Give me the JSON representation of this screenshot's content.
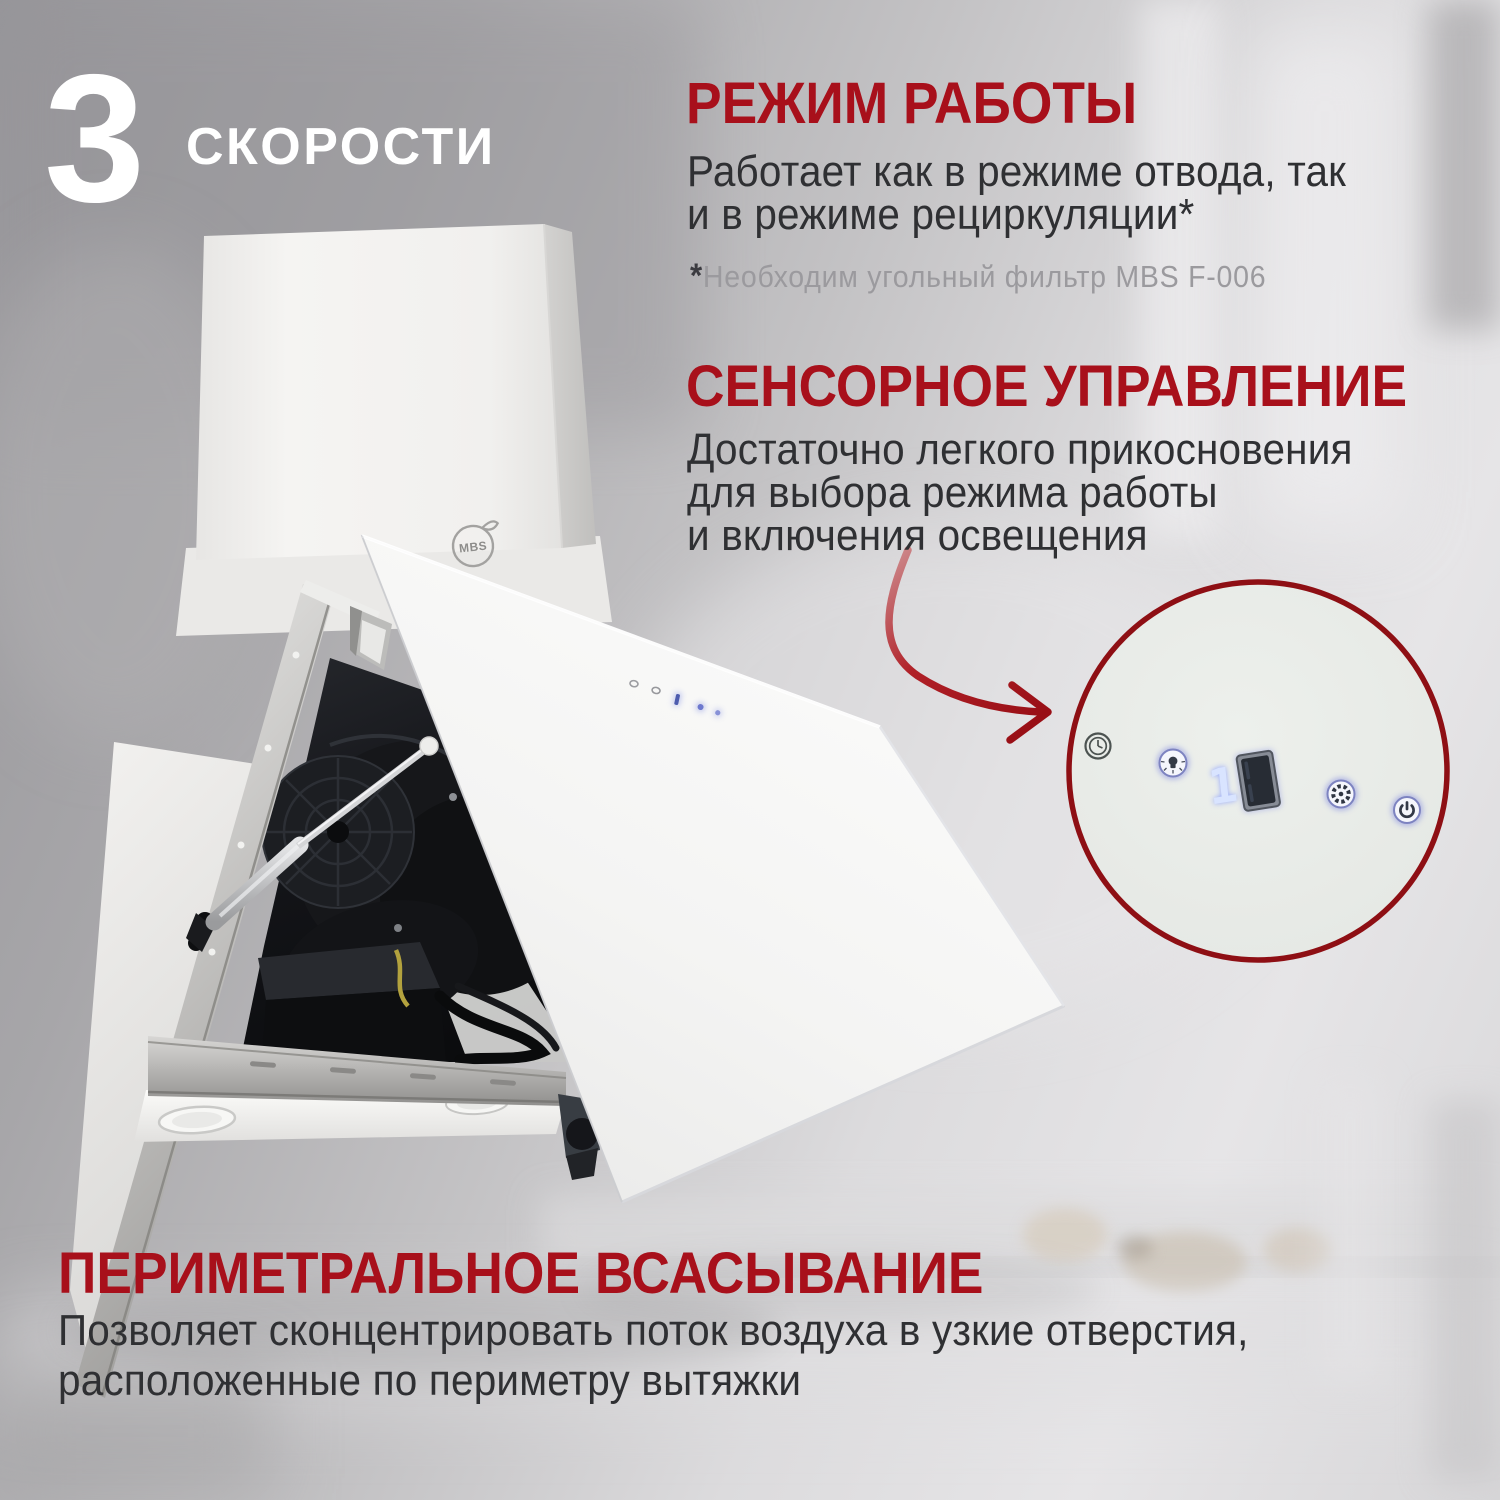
{
  "badge": {
    "number": "3",
    "label": "СКОРОСТИ"
  },
  "sections": {
    "mode": {
      "title": "РЕЖИМ РАБОТЫ",
      "body_lines": [
        "Работает как в режиме отвода, так",
        "и в режиме рециркуляции*"
      ],
      "footnote_star": "*",
      "footnote_text": "Необходим угольный фильтр MBS F-006"
    },
    "touch": {
      "title": "СЕНСОРНОЕ УПРАВЛЕНИЕ",
      "body_lines": [
        "Достаточно легкого прикосновения",
        "для выбора режима работы",
        "и включения освещения"
      ]
    },
    "perimeter": {
      "title": "ПЕРИМЕТРАЛЬНОЕ ВСАСЫВАНИЕ",
      "body_lines": [
        "Позволяет сконцентрировать поток воздуха в узкие отверстия,",
        "расположенные по периметру вытяжки"
      ]
    }
  },
  "product": {
    "brand": "MBS"
  },
  "control_panel": {
    "display_value": "1",
    "icons": [
      "timer-icon",
      "light-icon",
      "speed-display",
      "fan-icon",
      "power-icon"
    ]
  },
  "colors": {
    "accent_red": "#A8101B",
    "inset_border_red": "#8E0F14",
    "text_dark": "#2F3033",
    "text_muted": "#9B9A9E",
    "badge_white": "#FFFFFF",
    "glow_blue": "#8A90D8"
  }
}
